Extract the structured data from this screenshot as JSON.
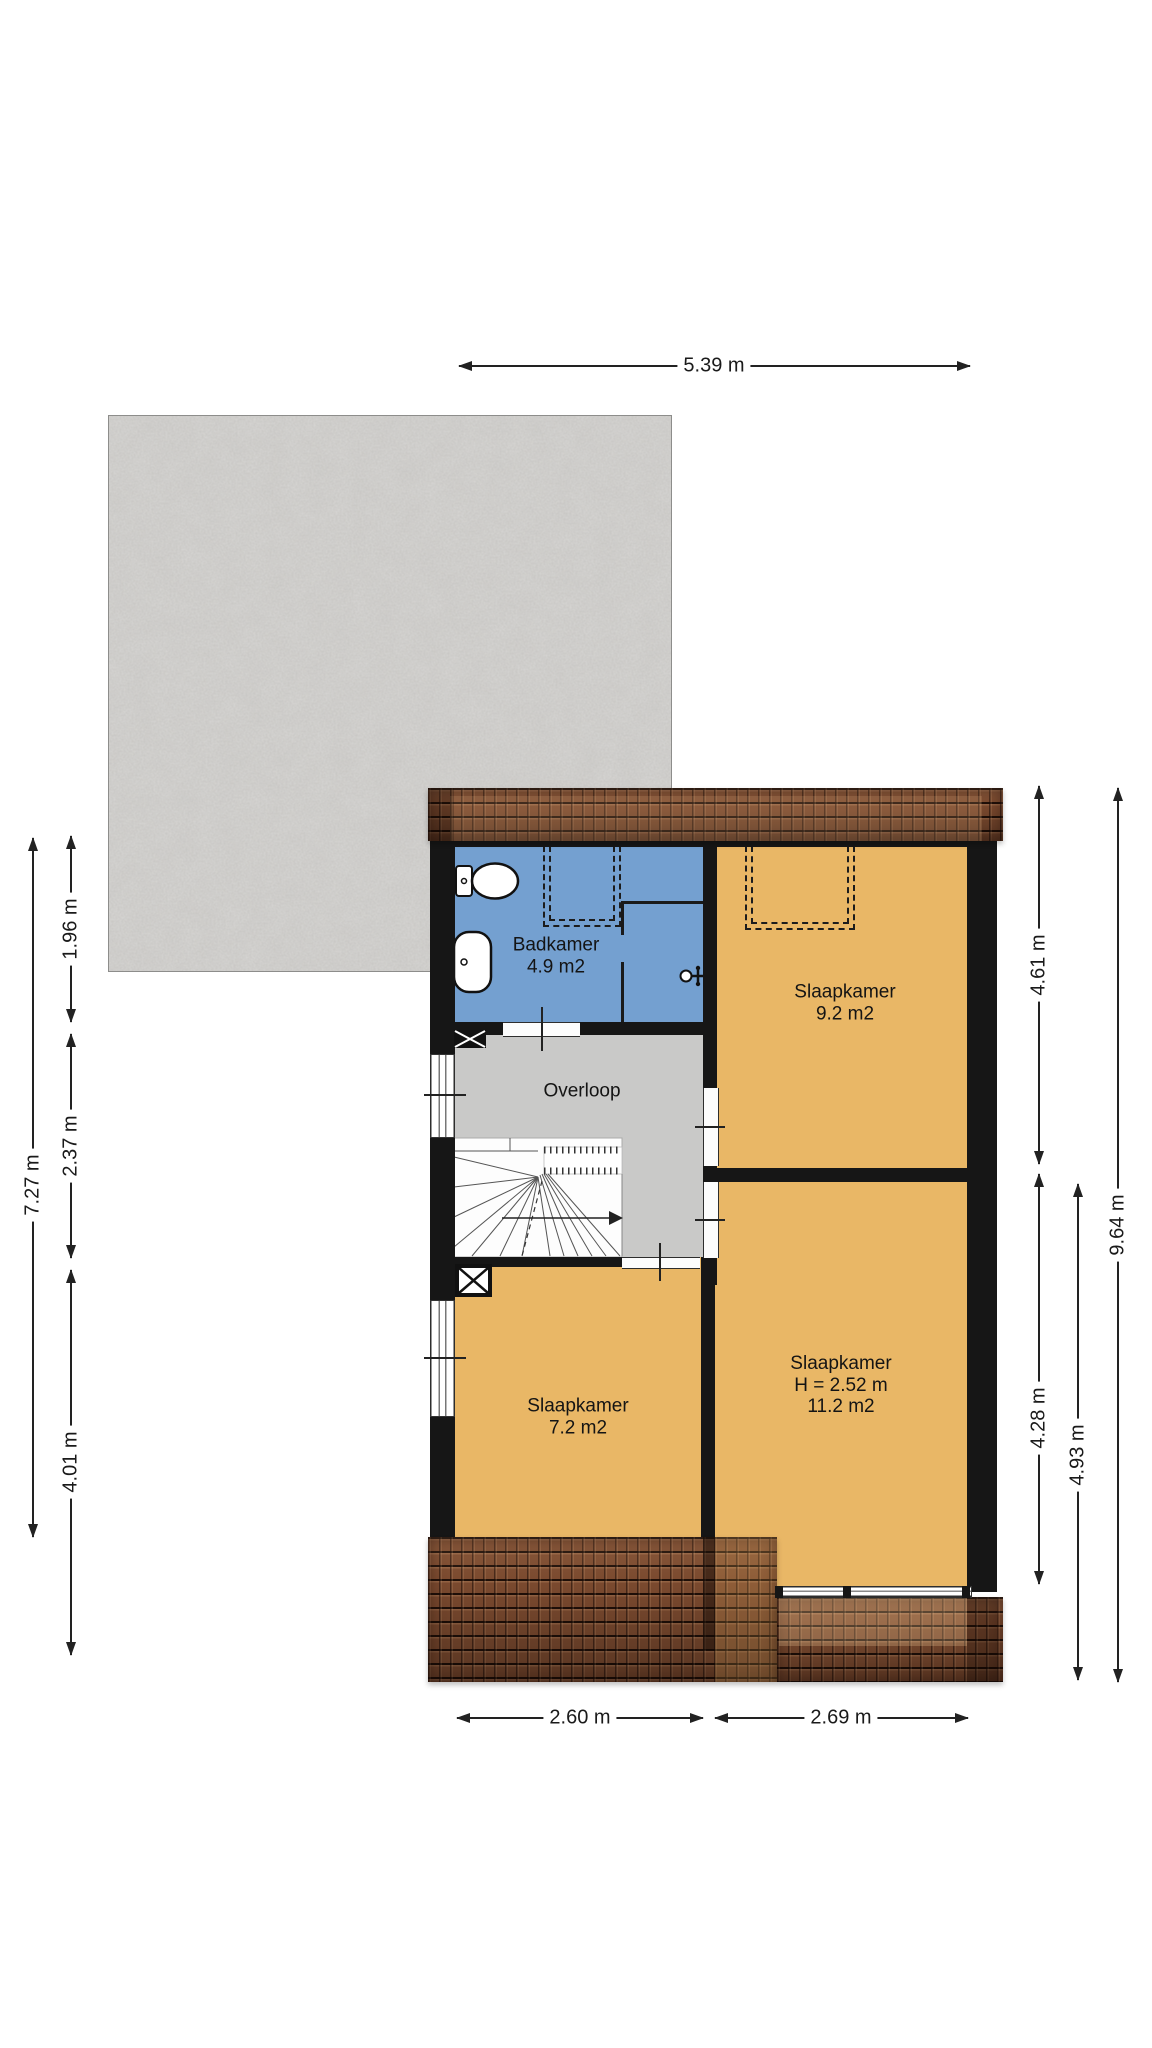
{
  "plan_type": "floorplan-upper-storey",
  "rooms": {
    "badkamer": {
      "name": "Badkamer",
      "area": "4.9 m2"
    },
    "slaapkamer_9_2": {
      "name": "Slaapkamer",
      "area": "9.2 m2"
    },
    "overloop": {
      "name": "Overloop"
    },
    "slaapkamer_7_2": {
      "name": "Slaapkamer",
      "area": "7.2 m2"
    },
    "slaapkamer_11_2": {
      "name": "Slaapkamer",
      "height": "H = 2.52 m",
      "area": "11.2 m2"
    }
  },
  "dimensions": {
    "top_width": "5.39 m",
    "left_total": "7.27 m",
    "left_upper": "1.96 m",
    "left_middle": "2.37 m",
    "left_lower": "4.01 m",
    "right_upper": "4.61 m",
    "right_lower": "4.28 m",
    "right_lower_outer": "4.93 m",
    "right_total": "9.64 m",
    "bottom_left": "2.60 m",
    "bottom_right": "2.69 m"
  },
  "colors": {
    "floor_orange": "#e9b766",
    "floor_blue": "#74a0d0",
    "floor_gray": "#c9c9c8",
    "wall_black": "#161616",
    "roof_brown": "#7b4a2f",
    "concrete_gray": "#d8d7d5",
    "dim_line": "#222222"
  },
  "icons": [
    "toilet-icon",
    "sink-icon",
    "shower-icon",
    "stairs-icon",
    "flue-box-icon",
    "window-symbol",
    "door-opening-symbol",
    "dormer-dashed-outline"
  ]
}
